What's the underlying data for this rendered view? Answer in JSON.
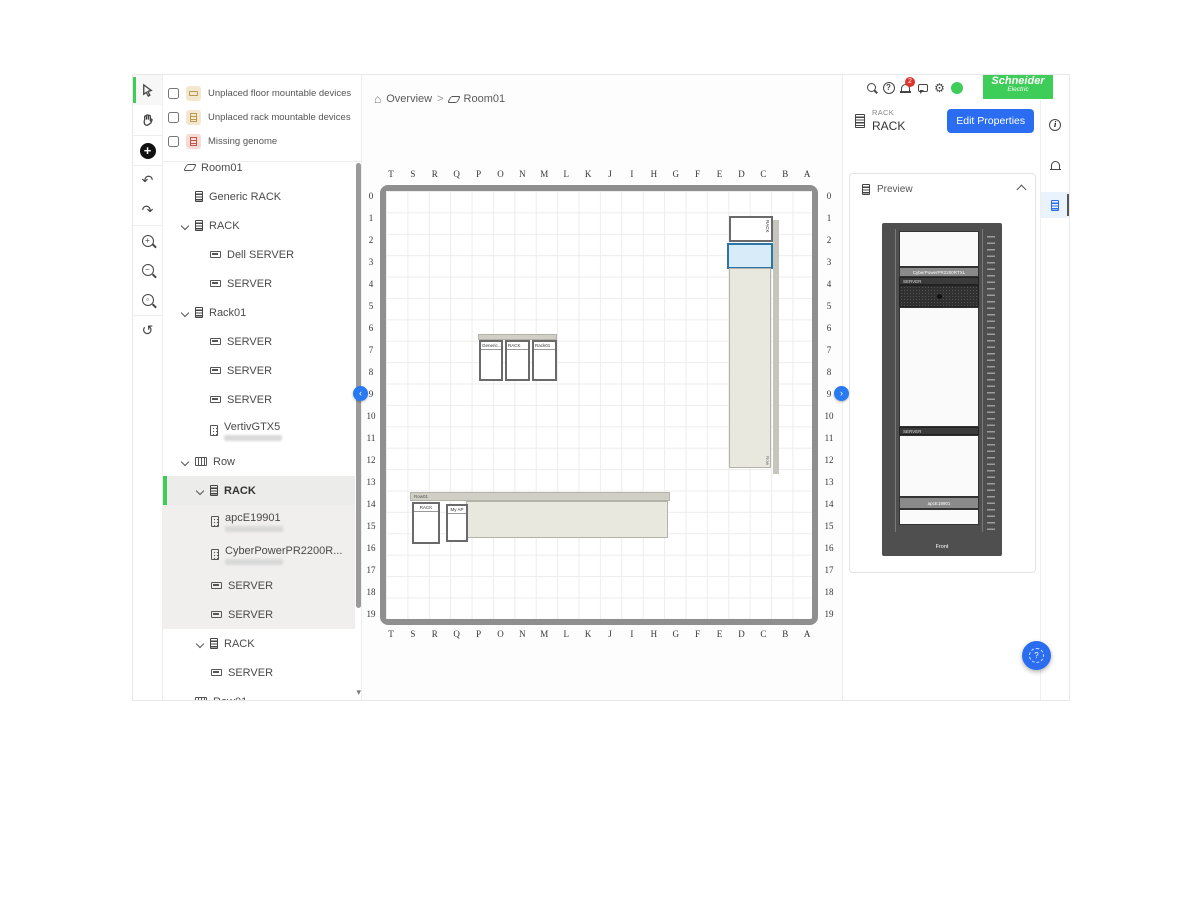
{
  "toolbar": {
    "tools": [
      {
        "name": "select-tool",
        "active": true
      },
      {
        "name": "pan-tool"
      },
      {
        "name": "add-tool"
      },
      {
        "name": "undo-tool",
        "glyph": "↶"
      },
      {
        "name": "redo-tool",
        "glyph": "↷"
      },
      {
        "name": "zoom-in-tool",
        "glyph": "+"
      },
      {
        "name": "zoom-out-tool",
        "glyph": "−"
      },
      {
        "name": "zoom-fit-tool",
        "glyph": "▫"
      },
      {
        "name": "history-tool",
        "glyph": "↺"
      }
    ]
  },
  "sidebar": {
    "filters": [
      {
        "label": "Unplaced floor mountable devices",
        "checked": false,
        "icon": "floor-device-chip"
      },
      {
        "label": "Unplaced rack mountable devices",
        "checked": false,
        "icon": "rack-device-chip"
      },
      {
        "label": "Missing genome",
        "checked": false,
        "icon": "missing-genome-chip"
      }
    ],
    "tree": [
      {
        "label": "Room01",
        "icon": "room-icon",
        "level": 0
      },
      {
        "label": "Generic RACK",
        "icon": "rack-icon",
        "level": 1
      },
      {
        "label": "RACK",
        "icon": "rack-icon",
        "level": 1,
        "expanded": true
      },
      {
        "label": "Dell SERVER",
        "icon": "server-icon",
        "level": 2
      },
      {
        "label": "SERVER",
        "icon": "server-icon",
        "level": 2
      },
      {
        "label": "Rack01",
        "icon": "rack-icon",
        "level": 1,
        "expanded": true
      },
      {
        "label": "SERVER",
        "icon": "server-icon",
        "level": 2
      },
      {
        "label": "SERVER",
        "icon": "server-icon",
        "level": 2
      },
      {
        "label": "SERVER",
        "icon": "server-icon",
        "level": 2
      },
      {
        "label": "VertivGTX5",
        "icon": "ups-icon",
        "level": 2,
        "subtitle_redacted": true
      },
      {
        "label": "Row",
        "icon": "row-icon",
        "level": 1,
        "expanded": true
      },
      {
        "label": "RACK",
        "icon": "rack-icon",
        "level": 2,
        "expanded": true,
        "selected": true
      },
      {
        "label": "apcE19901",
        "icon": "ups-icon",
        "level": 3,
        "subtitle_redacted": true
      },
      {
        "label": "CyberPowerPR2200R...",
        "icon": "ups-icon",
        "level": 3,
        "subtitle_redacted": true
      },
      {
        "label": "SERVER",
        "icon": "server-icon",
        "level": 3
      },
      {
        "label": "SERVER",
        "icon": "server-icon",
        "level": 3
      },
      {
        "label": "RACK",
        "icon": "rack-icon",
        "level": 2,
        "expanded": true
      },
      {
        "label": "SERVER",
        "icon": "server-icon",
        "level": 3
      },
      {
        "label": "Row01",
        "icon": "row-icon",
        "level": 1,
        "expanded": true
      }
    ]
  },
  "breadcrumb": {
    "home": "Overview",
    "separator": ">",
    "current": "Room01"
  },
  "floorplan": {
    "col_labels": [
      "T",
      "S",
      "R",
      "Q",
      "P",
      "O",
      "N",
      "M",
      "L",
      "K",
      "J",
      "I",
      "H",
      "G",
      "F",
      "E",
      "D",
      "C",
      "B",
      "A"
    ],
    "row_labels": [
      "0",
      "1",
      "2",
      "3",
      "4",
      "5",
      "6",
      "7",
      "8",
      "9",
      "10",
      "11",
      "12",
      "13",
      "14",
      "15",
      "16",
      "17",
      "18",
      "19"
    ],
    "objects": {
      "top_rack_label": "RACK",
      "vertical_row_label": "Row",
      "mid_rack_labels": [
        "Generic...",
        "RACK",
        "Rack01"
      ],
      "bottom_row_label": "Row01",
      "bottom_rack_labels": [
        "RACK",
        "My AP"
      ]
    },
    "panel_toggle_left": "‹",
    "panel_toggle_right": "›"
  },
  "header": {
    "notification_count": "2",
    "brand_line1": "Schneider",
    "brand_line2": "Electric",
    "help_glyph": "?",
    "gear_glyph": "⚙"
  },
  "details": {
    "type_label": "RACK",
    "name": "RACK",
    "edit_button": "Edit Properties"
  },
  "preview": {
    "title": "Preview",
    "front_label": "Front",
    "devices": {
      "ups_top": "CyberPowerPR2200RTXL",
      "server_top": "SERVER",
      "server_mid": "SERVER",
      "ups_bottom": "apcE19901"
    }
  },
  "strip": {
    "info_glyph": "i"
  },
  "colors": {
    "brand_green": "#3dcd58",
    "primary_blue": "#2b6df0",
    "selected_rack_fill": "#d7ebf8",
    "selected_rack_border": "#2d74a9",
    "badge_red": "#e0332b"
  }
}
